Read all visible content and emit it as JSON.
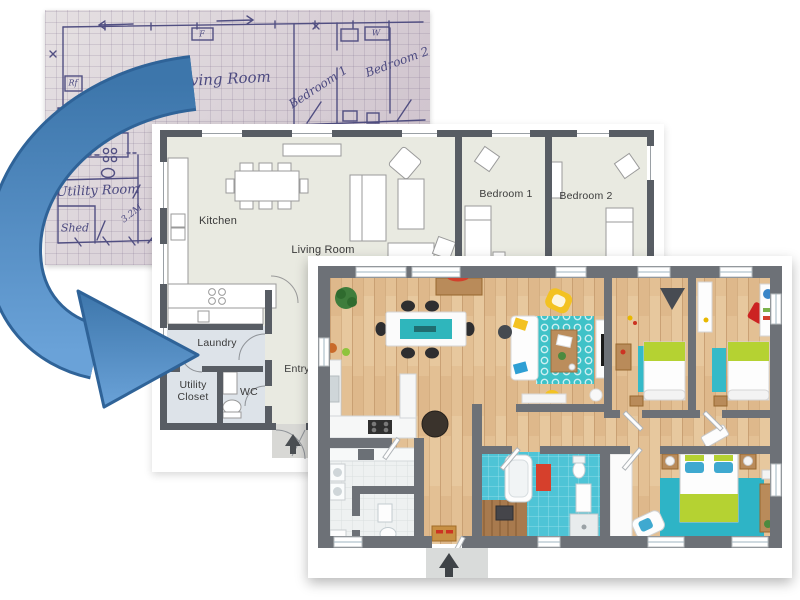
{
  "title": "Hand-drawn sketch converted to 2D and 3D floor plans",
  "sketch": {
    "labels": {
      "living_room": "Living Room",
      "bedroom_1": "Bedroom 1",
      "bedroom_2": "Bedroom 2",
      "utility_room": "Utility Room",
      "shed": "Shed",
      "dimension": "3.2M",
      "fridge": "Rf",
      "fixture": "F",
      "wardrobe": "W"
    },
    "ink_color": "#4c4a80",
    "paper_color": "#d9d2d8"
  },
  "plan_2d": {
    "labels": {
      "kitchen": "Kitchen",
      "living_room": "Living Room",
      "bedroom_1": "Bedroom 1",
      "bedroom_2": "Bedroom 2",
      "laundry": "Laundry",
      "utility_closet": "Utility Closet",
      "wc": "WC",
      "entry": "Entry"
    },
    "wall_color": "#585d64",
    "floor_color": "#e9eae1",
    "wet_room_color": "#dde3e9"
  },
  "plan_3d": {
    "wall_color": "#6d7177",
    "floor_wood_color": "#e2c094",
    "bathroom_tile_color": "#4ec4d6",
    "rug_color": "#2fb4c6",
    "bed_linen_color": "#b5d232",
    "accent_yellow": "#f3c222",
    "accent_red": "#d2402c"
  },
  "arrow": {
    "color_top": "#3d76ab",
    "color_bottom": "#6aa2d8",
    "outline_color": "#2f6398"
  }
}
